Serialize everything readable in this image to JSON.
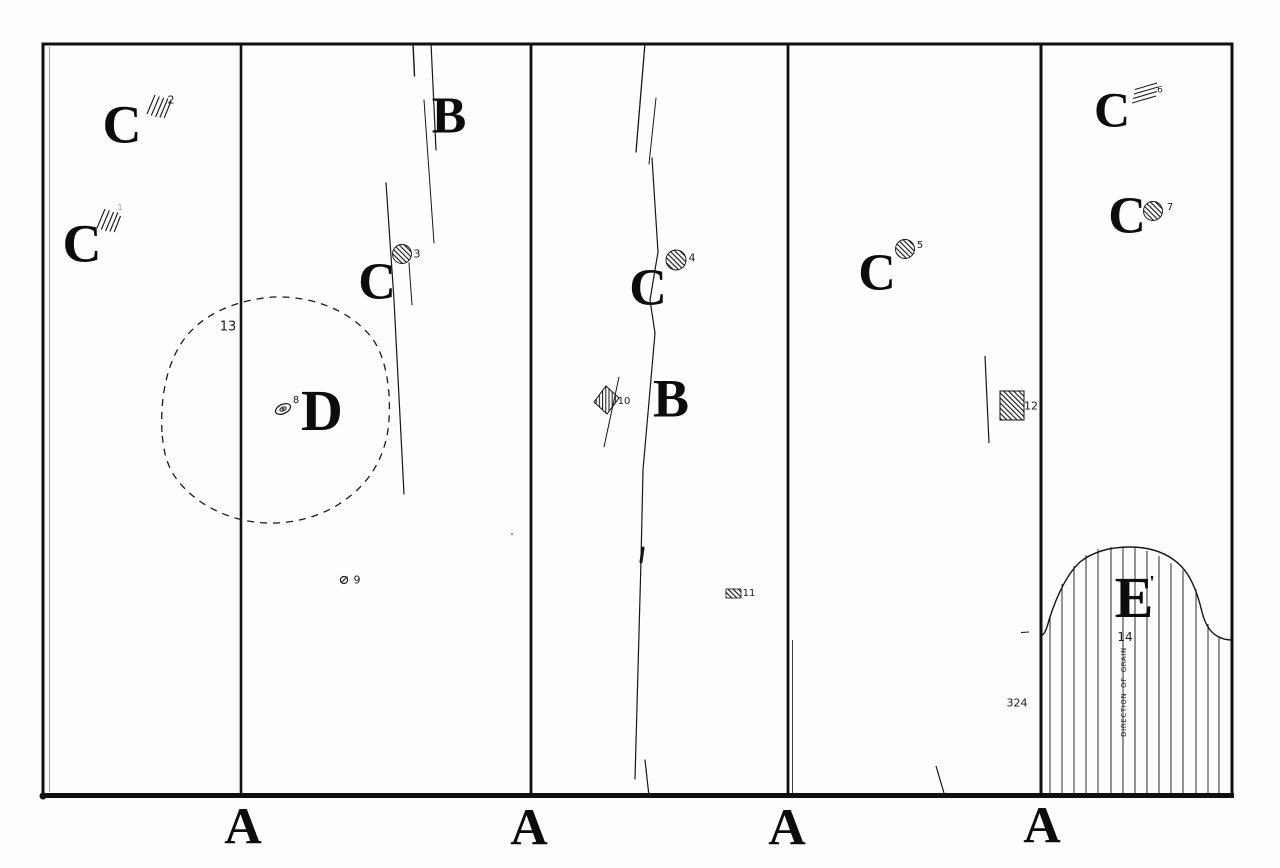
{
  "colors": {
    "ink": "#111111",
    "paper": "#fdfdfb"
  },
  "letters": {
    "C1": "C",
    "C2": "C",
    "C3": "C",
    "C4": "C",
    "C5": "C",
    "C6": "C",
    "C7": "C",
    "B1": "B",
    "B2": "B",
    "D": "D",
    "E": "E",
    "E_tick": "'",
    "A1": "A",
    "A2": "A",
    "A3": "A",
    "A4": "A"
  },
  "ref_numbers": {
    "n1": "1",
    "n2": "2",
    "n3": "3",
    "n4": "4",
    "n5": "5",
    "n6": "6",
    "n7": "7",
    "n8": "8",
    "n9": "9",
    "n10": "10",
    "n11": "11",
    "n12": "12",
    "n13": "13",
    "n14": "14",
    "n324": "324"
  },
  "grain_label": "DIRECTION OF GRAIN"
}
